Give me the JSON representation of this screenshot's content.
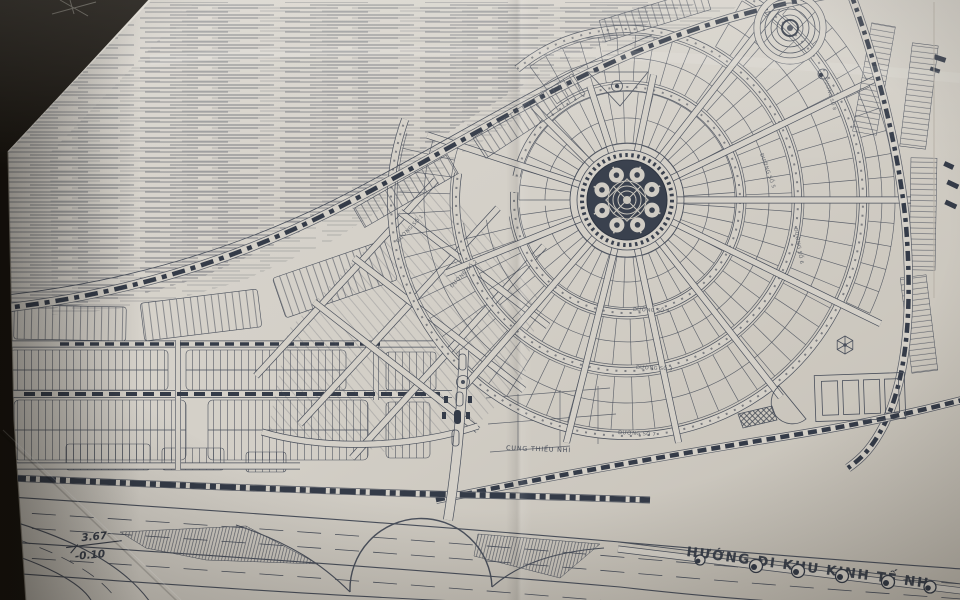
{
  "scene": {
    "description": "Photographed paper urban master plan drawing",
    "language": "vi"
  },
  "colors": {
    "table": "#16120d",
    "paper": "#d4d0c8",
    "paper_dark": "#beb8ae",
    "ink": "#4a505c",
    "ink_bold": "#343b48",
    "plaza": "#3a414e"
  },
  "labels": {
    "direction_road": "HƯỚNG ĐI KHU KINH TẾ NH",
    "children_palace": "CUNG THIẾU NHI",
    "elevation_top": "3.67",
    "elevation_bottom": "-0.10"
  },
  "street_labels": [
    {
      "text": "ĐƯỜNG SỐ 4",
      "x": 633,
      "y": 311,
      "r": 2,
      "s": 5
    },
    {
      "text": "ĐƯỜNG SỐ 3",
      "x": 636,
      "y": 369,
      "r": 2,
      "s": 5
    },
    {
      "text": "ĐƯỜNG SỐ 7",
      "x": 618,
      "y": 434,
      "r": 3,
      "s": 5.2
    },
    {
      "text": "ĐƯỜNG SỐ 1",
      "x": 398,
      "y": 243,
      "r": -46,
      "s": 5
    },
    {
      "text": "ĐƯỜNG SỐ 2",
      "x": 452,
      "y": 288,
      "r": -46,
      "s": 5
    },
    {
      "text": "ĐƯỜNG SỐ 5",
      "x": 760,
      "y": 154,
      "r": 70,
      "s": 5
    },
    {
      "text": "ĐƯỜNG SỐ 6",
      "x": 794,
      "y": 228,
      "r": 80,
      "s": 5
    },
    {
      "text": "ĐƯỜNG SỐ 8",
      "x": 824,
      "y": 78,
      "r": 74,
      "s": 4.6
    }
  ]
}
